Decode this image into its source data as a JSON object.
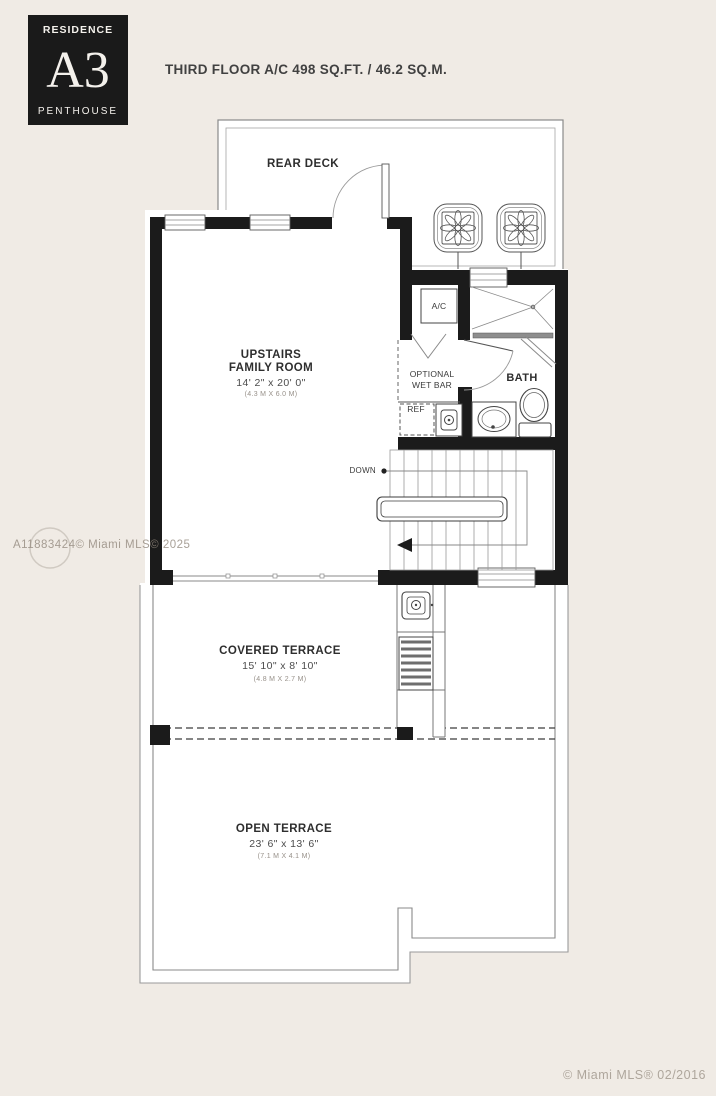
{
  "badge": {
    "label": "RESIDENCE",
    "unit": "A3",
    "sub": "PENTHOUSE"
  },
  "title": "THIRD FLOOR A/C 498 SQ.FT. / 46.2 SQ.M.",
  "rooms": {
    "rear_deck": {
      "name": "REAR DECK"
    },
    "family_room": {
      "line1": "UPSTAIRS",
      "line2": "FAMILY ROOM",
      "dims": "14' 2\" x 20' 0\"",
      "metric": "(4.3 M X 6.0 M)"
    },
    "ac_closet": {
      "name": "A/C"
    },
    "wet_bar": {
      "line1": "OPTIONAL",
      "line2": "WET BAR"
    },
    "bath": {
      "name": "BATH"
    },
    "fridge": {
      "name": "REF"
    },
    "stairs": {
      "label": "DOWN"
    },
    "covered_terrace": {
      "name": "COVERED TERRACE",
      "dims": "15' 10\" x 8' 10\"",
      "metric": "(4.8 M X 2.7 M)"
    },
    "open_terrace": {
      "name": "OPEN TERRACE",
      "dims": "23' 6\" x 13' 6\"",
      "metric": "(7.1 M X 4.1 M)"
    }
  },
  "watermarks": {
    "mid": "A11883424© Miami MLS© 2025",
    "bottom": "© Miami MLS® 02/2016"
  },
  "colors": {
    "background": "#f0ebe5",
    "wall": "#1b1b1b",
    "paper": "#ffffff",
    "line": "#8a8a8a"
  }
}
